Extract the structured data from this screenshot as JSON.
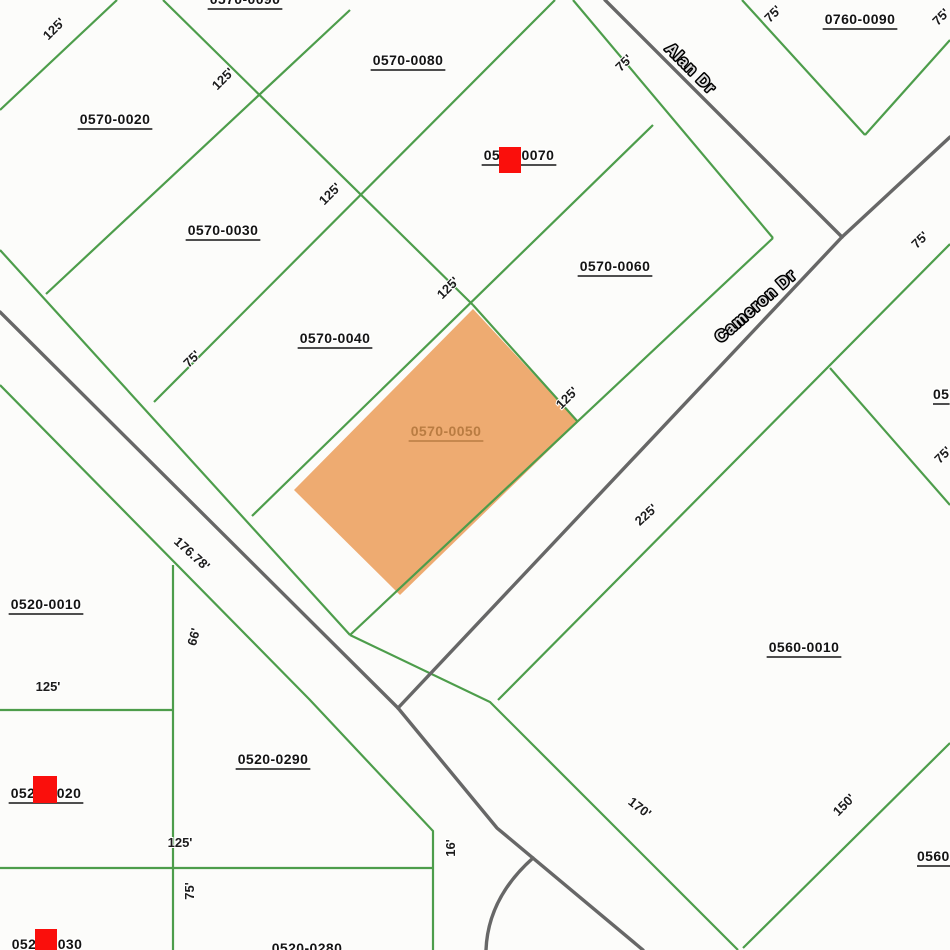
{
  "map": {
    "background": "#fcfcfa",
    "colors": {
      "parcel_line": "#4d9d4b",
      "street_line": "#676767",
      "parcel_label_text": "#141414",
      "highlight_fill": "#eda769",
      "highlight_label_text": "#b97c42",
      "marker_red": "#fa0f0c",
      "street_name_fill": "#dcdcdc",
      "street_name_outline": "#000000"
    },
    "street_names": [
      {
        "label": "Alan Dr",
        "x": 687,
        "y": 72,
        "rotation": 45
      },
      {
        "label": "Cameron Dr",
        "x": 759,
        "y": 310,
        "rotation": -41
      }
    ],
    "parcel_labels": [
      {
        "id": "0570-0090",
        "x": 245,
        "y": -1,
        "cut": "top"
      },
      {
        "id": "0570-0080",
        "x": 408,
        "y": 60
      },
      {
        "id": "0570-0070",
        "x": 519,
        "y": 155
      },
      {
        "id": "0760-0090",
        "x": 860,
        "y": 19
      },
      {
        "id": "0570-0020",
        "x": 115,
        "y": 119
      },
      {
        "id": "0570-0030",
        "x": 223,
        "y": 230
      },
      {
        "id": "0570-0040",
        "x": 335,
        "y": 338
      },
      {
        "id": "0570-0060",
        "x": 615,
        "y": 266
      },
      {
        "id": "0570-0050",
        "x": 446,
        "y": 431,
        "highlighted": true
      },
      {
        "id": "0560-0010",
        "x": 804,
        "y": 647
      },
      {
        "id": "0520-0010",
        "x": 46,
        "y": 604
      },
      {
        "id": "0520-0290",
        "x": 273,
        "y": 759
      },
      {
        "id": "0520-0020",
        "x": 46,
        "y": 793
      },
      {
        "id": "0520-0030",
        "x": 47,
        "y": 944,
        "cut": "bottom"
      },
      {
        "id": "0520-0280",
        "x": 307,
        "y": 948,
        "cut": "bottom"
      },
      {
        "id": "0560-",
        "x": 917,
        "y": 856,
        "anchor": "start",
        "cut": "right"
      },
      {
        "id": "05",
        "x": 933,
        "y": 394,
        "anchor": "start",
        "cut": "right"
      }
    ],
    "markers": [
      {
        "x": 499,
        "y": 147,
        "w": 22,
        "h": 26
      },
      {
        "x": 33,
        "y": 776,
        "w": 24,
        "h": 27
      },
      {
        "x": 35,
        "y": 929,
        "w": 22,
        "h": 21
      }
    ],
    "dimension_labels": [
      {
        "text": "125'",
        "x": 57,
        "y": 32,
        "rotation": -45
      },
      {
        "text": "125'",
        "x": 226,
        "y": 82,
        "rotation": -45
      },
      {
        "text": "125'",
        "x": 333,
        "y": 197,
        "rotation": -45
      },
      {
        "text": "125'",
        "x": 451,
        "y": 291,
        "rotation": -45
      },
      {
        "text": "125'",
        "x": 570,
        "y": 401,
        "rotation": -45
      },
      {
        "text": "75'",
        "x": 627,
        "y": 66,
        "rotation": -45
      },
      {
        "text": "75'",
        "x": 776,
        "y": 17,
        "rotation": -45
      },
      {
        "text": "75'",
        "x": 944,
        "y": 20,
        "rotation": -45
      },
      {
        "text": "75'",
        "x": 195,
        "y": 362,
        "rotation": -45
      },
      {
        "text": "75'",
        "x": 923,
        "y": 243,
        "rotation": -45
      },
      {
        "text": "75'",
        "x": 946,
        "y": 458,
        "rotation": -45
      },
      {
        "text": "225'",
        "x": 649,
        "y": 518,
        "rotation": -42
      },
      {
        "text": "170'",
        "x": 637,
        "y": 811,
        "rotation": 38
      },
      {
        "text": "150'",
        "x": 847,
        "y": 808,
        "rotation": -45
      },
      {
        "text": "176.78'",
        "x": 189,
        "y": 557,
        "rotation": 42
      },
      {
        "text": "66'",
        "x": 198,
        "y": 638,
        "rotation": -75
      },
      {
        "text": "16'",
        "x": 455,
        "y": 848,
        "rotation": -90
      },
      {
        "text": "75'",
        "x": 194,
        "y": 891,
        "rotation": -90
      },
      {
        "text": "125'",
        "x": 180,
        "y": 847,
        "rotation": 0
      },
      {
        "text": "125'",
        "x": 48,
        "y": 691,
        "rotation": 0
      }
    ],
    "highlighted_parcel": {
      "id": "0570-0050",
      "points": "473,309 578,422 400,595 294,490"
    },
    "parcel_lines": [
      "M117,0 L0,110",
      "M350,10 L46,294",
      "M555,0 L154,402",
      "M653,125 L252,516",
      "M163,0 L473,305",
      "M473,305 L578,422",
      "M573,0 L773,238",
      "M742,0 L865,135",
      "M865,135 L950,40",
      "M773,238 L350,635",
      "M0,250 L350,635",
      "M350,635 L490,702 L630,842 L738,950",
      "M0,385 L310,700 L433,831 L433,950",
      "M0,710 L173,710",
      "M0,868 L433,868",
      "M173,565 L173,950",
      "M950,244 L498,700",
      "M830,368 L950,505",
      "M950,743 L743,948"
    ],
    "street_lines": [
      "M605,0 L842,237",
      "M950,137 L842,237",
      "M842,237 L398,708",
      "M0,312 L398,708",
      "M398,708 L497,828 L643,950",
      "M533,858 Q488,898 486,950"
    ]
  }
}
